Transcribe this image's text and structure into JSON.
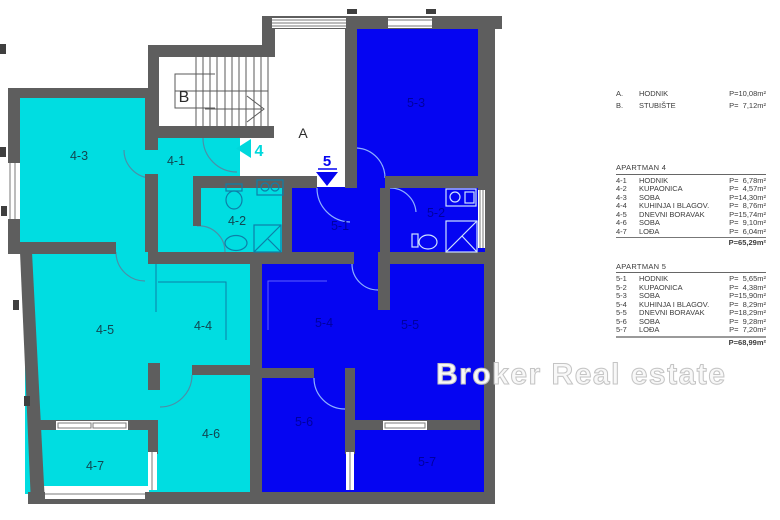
{
  "watermark": "Broker Real estate",
  "plan": {
    "hall_label": "A",
    "stair_label": "B",
    "apt4_arrow": "4",
    "apt5_arrow": "5",
    "rooms": {
      "r4_1": "4-1",
      "r4_2": "4-2",
      "r4_3": "4-3",
      "r4_4": "4-4",
      "r4_5": "4-5",
      "r4_6": "4-6",
      "r4_7": "4-7",
      "r5_1": "5-1",
      "r5_2": "5-2",
      "r5_3": "5-3",
      "r5_4": "5-4",
      "r5_5": "5-5",
      "r5_6": "5-6",
      "r5_7": "5-7"
    },
    "colors": {
      "apt4": "#00dde1",
      "apt5": "#0505f2",
      "wall": "#5e5e5e"
    }
  },
  "legend": {
    "common": {
      "rows": [
        {
          "id": "A.",
          "name": "HODNIK",
          "area": "P=10,08m²"
        },
        {
          "id": "B.",
          "name": "STUBIŠTE",
          "area": "P=  7,12m²"
        }
      ]
    },
    "apartments": [
      {
        "title": "APARTMAN 4",
        "rows": [
          {
            "id": "4-1",
            "name": "HODNIK",
            "area": "P=  6,78m²"
          },
          {
            "id": "4-2",
            "name": "KUPAONICA",
            "area": "P=  4,57m²"
          },
          {
            "id": "4-3",
            "name": "SOBA",
            "area": "P=14,30m²"
          },
          {
            "id": "4-4",
            "name": "KUHINJA I BLAGOV.",
            "area": "P=  8,76m²"
          },
          {
            "id": "4-5",
            "name": "DNEVNI BORAVAK",
            "area": "P=15,74m²"
          },
          {
            "id": "4-6",
            "name": "SOBA",
            "area": "P=  9,10m²"
          },
          {
            "id": "4-7",
            "name": "LOĐA",
            "area": "P=  6,04m²"
          }
        ],
        "total": "P=65,29m²"
      },
      {
        "title": "APARTMAN 5",
        "rows": [
          {
            "id": "5-1",
            "name": "HODNIK",
            "area": "P=  5,65m²"
          },
          {
            "id": "5-2",
            "name": "KUPAONICA",
            "area": "P=  4,38m²"
          },
          {
            "id": "5-3",
            "name": "SOBA",
            "area": "P=15,90m²"
          },
          {
            "id": "5-4",
            "name": "KUHINJA I BLAGOV.",
            "area": "P=  8,29m²"
          },
          {
            "id": "5-5",
            "name": "DNEVNI BORAVAK",
            "area": "P=18,29m²"
          },
          {
            "id": "5-6",
            "name": "SOBA",
            "area": "P=  9,28m²"
          },
          {
            "id": "5-7",
            "name": "LOĐA",
            "area": "P=  7,20m²"
          }
        ],
        "total": "P=68,99m²"
      }
    ]
  }
}
